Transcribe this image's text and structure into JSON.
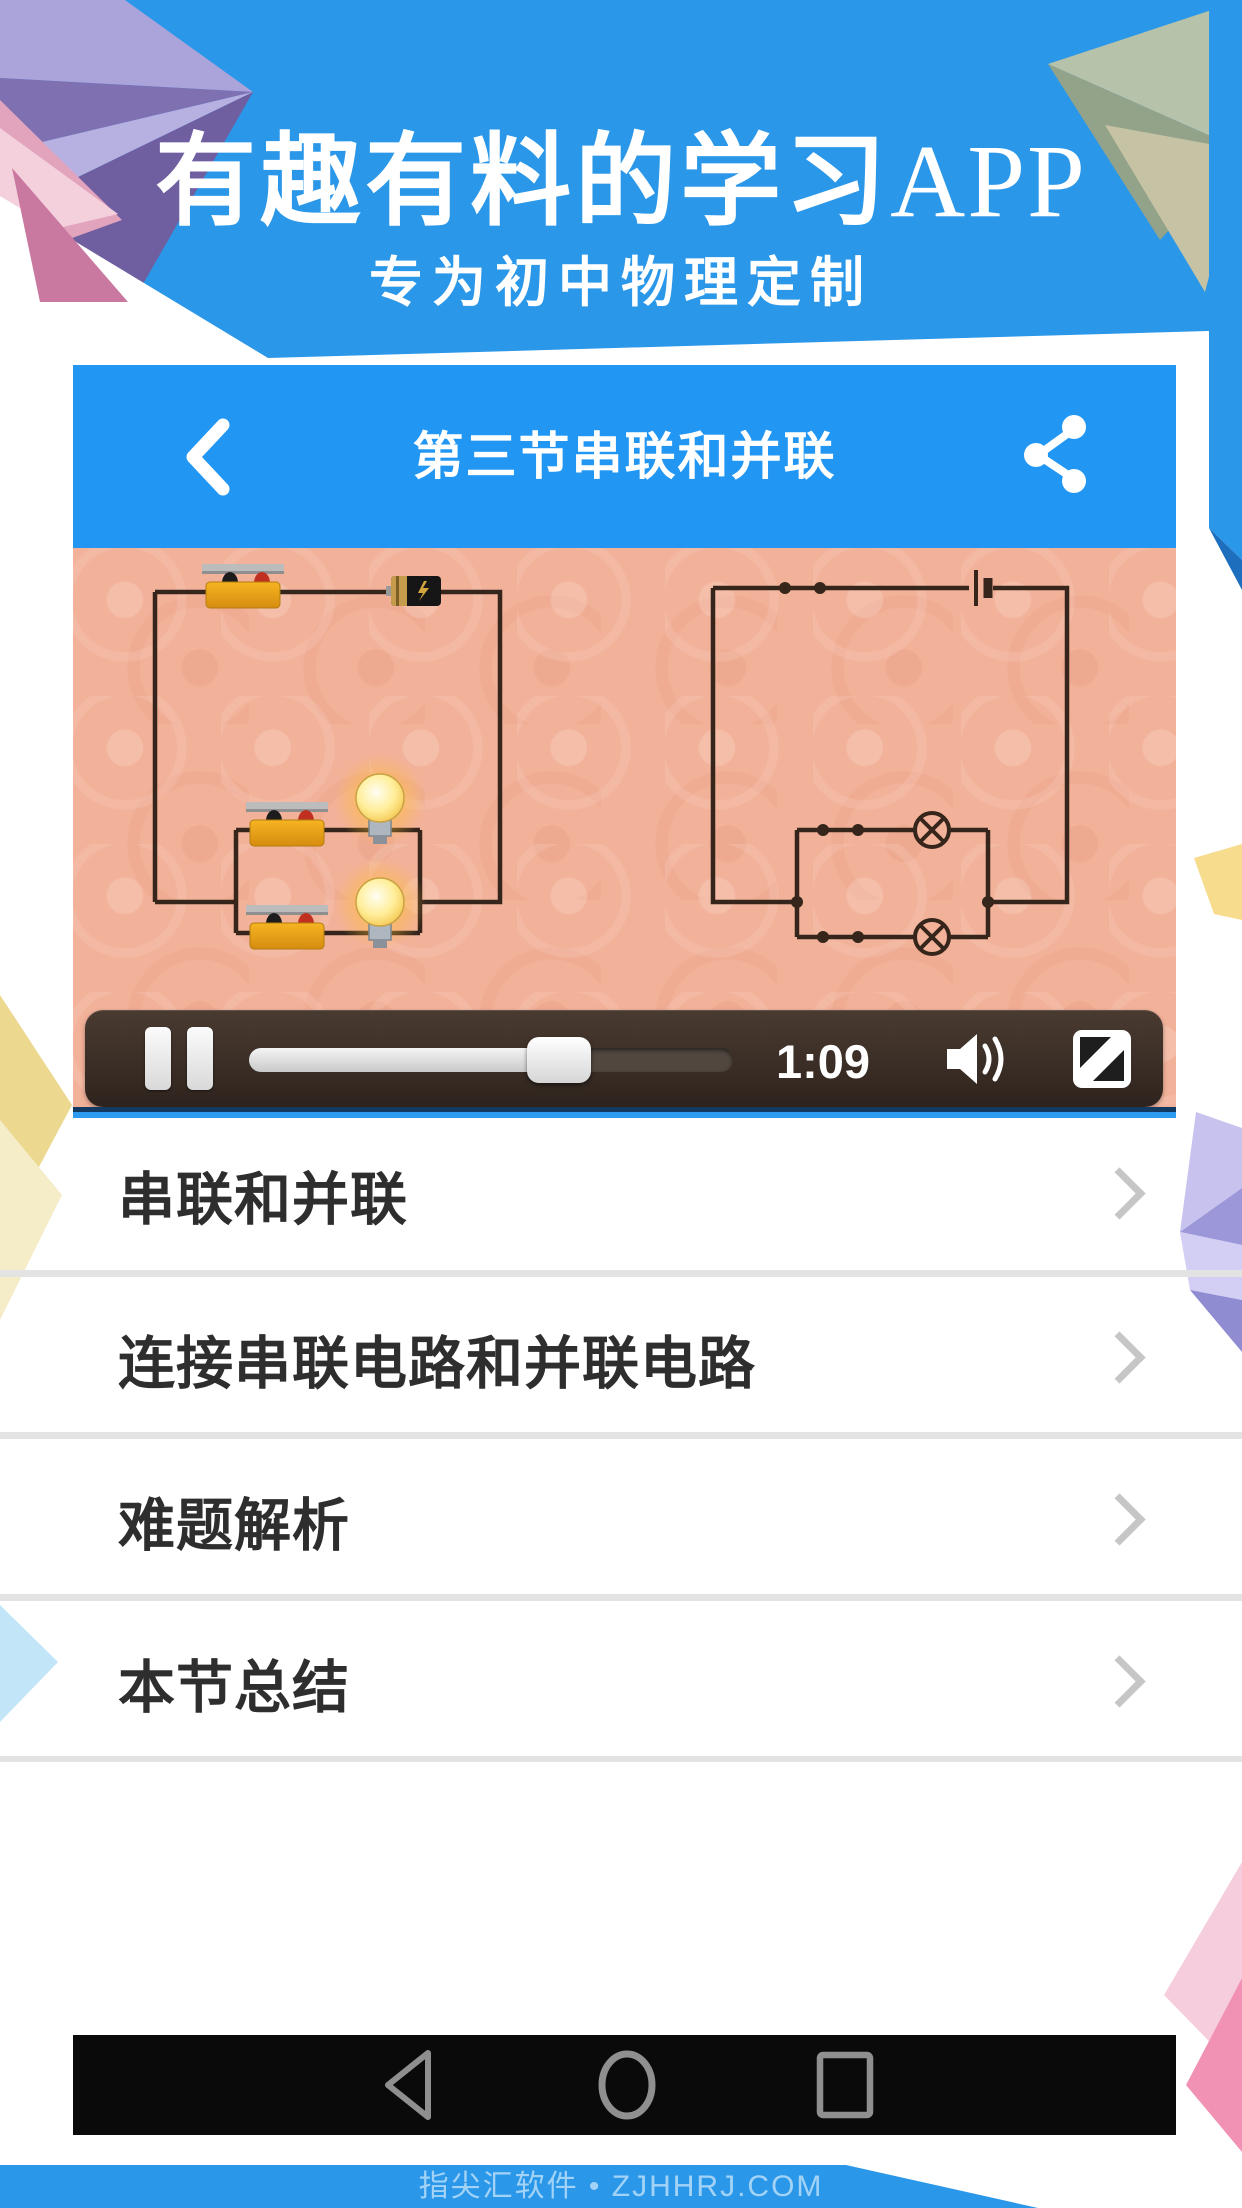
{
  "hero": {
    "title_main": "有趣有料的学习",
    "title_suffix": "APP",
    "subtitle": "专为初中物理定制"
  },
  "appbar": {
    "title": "第三节串联和并联",
    "back_icon": "chevron-left-icon",
    "share_icon": "share-icon"
  },
  "player": {
    "time": "1:09",
    "progress_percent": 64,
    "pause_icon": "pause-icon",
    "volume_icon": "speaker-icon",
    "fullscreen_icon": "fullscreen-icon"
  },
  "video": {
    "content": "series-and-parallel-circuit-demo"
  },
  "list": {
    "items": [
      {
        "label": "串联和并联"
      },
      {
        "label": "连接串联电路和并联电路"
      },
      {
        "label": "难题解析"
      },
      {
        "label": "本节总结"
      }
    ],
    "chevron_icon": "chevron-right-icon"
  },
  "navbar": {
    "back_icon": "back-triangle-icon",
    "home_icon": "home-circle-icon",
    "recent_icon": "recent-square-icon"
  },
  "footer": {
    "watermark": "指尖汇软件 • ZJHHRJ.COM"
  },
  "colors": {
    "background_blue": "#2a97e9",
    "appbar_blue": "#2196f3",
    "video_bg": "#f2b199",
    "controlbar_brown": "#3a2d25",
    "divider_gray": "#e3e3e3",
    "text_dark": "#2e2e2e"
  }
}
